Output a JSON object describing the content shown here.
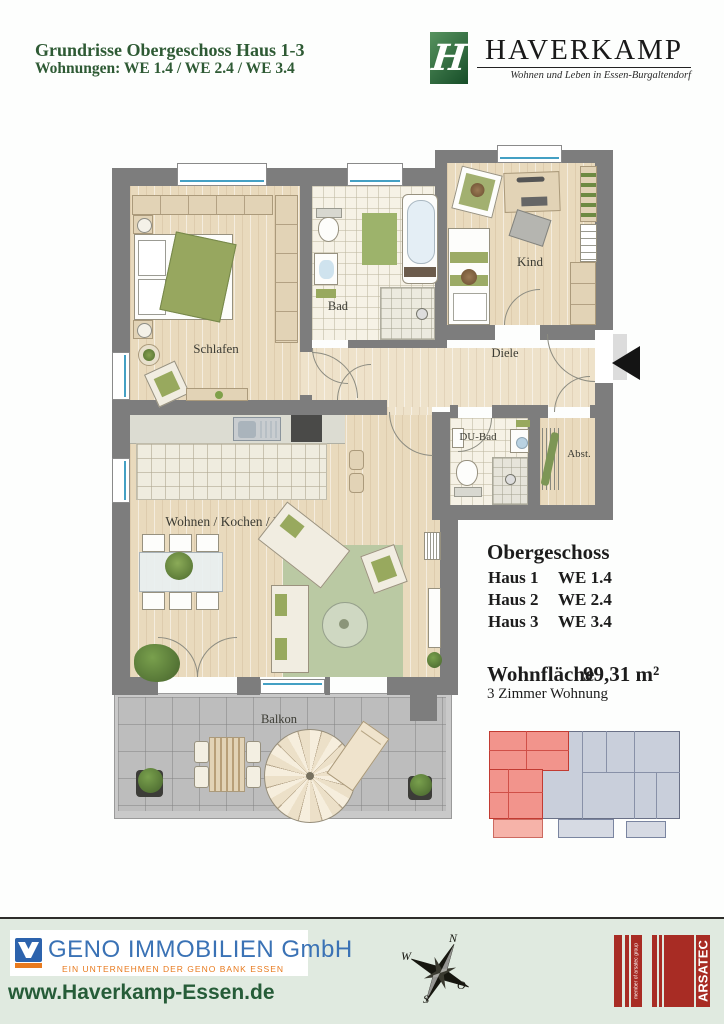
{
  "header": {
    "title": "Grundrisse Obergeschoss Haus 1-3",
    "subtitle": "Wohnungen:  WE 1.4 / WE 2.4 / WE 3.4"
  },
  "brand": {
    "name": "HAVERKAMP",
    "monogram": "H",
    "tagline": "Wohnen und Leben in Essen-Burgaltendorf"
  },
  "floorplan": {
    "labels": {
      "schlafen": "Schlafen",
      "bad": "Bad",
      "kind": "Kind",
      "diele": "Diele",
      "dubad": "DU-Bad",
      "abst": "Abst.",
      "wohnen": "Wohnen / Kochen / Essen",
      "balkon": "Balkon"
    }
  },
  "info": {
    "floor_title": "Obergeschoss",
    "units": [
      {
        "house": "Haus 1",
        "unit": "WE 1.4"
      },
      {
        "house": "Haus 2",
        "unit": "WE 2.4"
      },
      {
        "house": "Haus 3",
        "unit": "WE 3.4"
      }
    ],
    "area_label": "Wohnfläche",
    "area_value": "99,31 m²",
    "apartment_type": "3 Zimmer Wohnung"
  },
  "footer": {
    "company": "GENO IMMOBILIEN GmbH",
    "company_subtitle": "EIN UNTERNEHMEN DER GENO BANK ESSEN",
    "website": "www.Haverkamp-Essen.de",
    "compass": {
      "n": "N",
      "w": "W",
      "o": "O",
      "s": "S"
    },
    "partner": {
      "name": "ARSATEC",
      "suffix": "GmbH",
      "tagline": "member of arsatec group"
    }
  },
  "colors": {
    "header_green": "#2e5a34",
    "brand_green": "#2b6b3d",
    "footer_bg": "#e0eae0",
    "geno_blue": "#3a72b5",
    "geno_orange": "#e87a1e",
    "arsatec_red": "#a82c24",
    "highlight_red": "#f2948c"
  }
}
